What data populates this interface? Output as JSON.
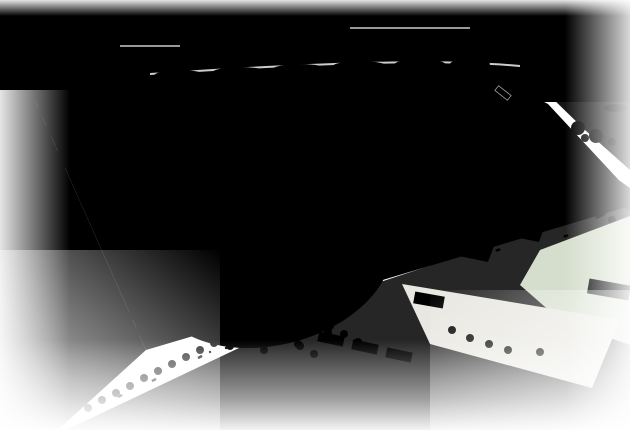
{
  "meta": {
    "kind": "watercolor aerial perspective rendering",
    "subject": "seaside sports park with ballfields, stadium, lawns, parking and coastal river",
    "canvas": {
      "width": 630,
      "height": 430
    }
  },
  "scene": {
    "features": [
      "ocean with breakwater jetty at top",
      "beach and green dune belt",
      "perimeter forest belt",
      "two sand ballfields (upper-left)",
      "central softball stadium with sand infield, blue grandstand and tall net poles",
      "large green turf field with white lines",
      "grey gravel multipurpose ground",
      "pond and circular tree plaza",
      "three car parking lots with colored cars",
      "river mouth with bridge at upper right",
      "boulevard intersection with crosswalks at lower right",
      "faded sketch of existing lots and buildings at bottom edges"
    ]
  },
  "palette": {
    "paper": "#ffffff",
    "sky_top": "#ffffff",
    "sky": "#dff0f6",
    "sea": "#a5dbea",
    "sea_deep": "#8fd2e4",
    "sea_light": "#cfeaf3",
    "sea_streak": "#76c8dc",
    "beach": "#f0e8d2",
    "beach_bright": "#f8f2e3",
    "dune": "#c0e59d",
    "dune_dark": "#8ccf68",
    "tree_dark": "#3d9c38",
    "tree_mid": "#5fb848",
    "tree_light": "#8bcf66",
    "tree_faint": "#cfe4c2",
    "lawn_pale": "#e7f3d6",
    "lawn_light": "#c8e9a4",
    "lawn_bright": "#6fd048",
    "field_green": "#b7e492",
    "sand_light": "#e4d3af",
    "sand": "#d8c29a",
    "sand_line": "#cbb68c",
    "gravel": "#e0dfd5",
    "gravel_dot": "#bdbcae",
    "road": "#9ba1a6",
    "road_light": "#c9cdcf",
    "sidewalk": "#dadcd8",
    "path": "#ecebe0",
    "median": "#56bd45",
    "pond": "#a9deed",
    "river": "#93d4e4",
    "bank_green": "#7cc95e",
    "asphalt": "#c6c9cc",
    "lot_faded": "#ebeae3",
    "speckle": "#f1f1ed",
    "speckle_dot": "#b9b9b2",
    "stand_blue": "#4f7fc4",
    "stand_dark": "#38619e",
    "bldg_white": "#f6f6f2",
    "bldg_grey": "#d9dbd7",
    "bldg_edge": "#b0b0a6",
    "roof_tan": "#e2cf96",
    "line_white": "#ffffff",
    "fence_grey": "#c6cbcd",
    "sketch": "#d6d5cd",
    "sketch_green": "#c4d9b2",
    "sketch_tan": "#dcd3ba",
    "car_red": "#cf3d3a",
    "car_blue": "#3f65c0",
    "car_white": "#fafafa",
    "car_silver": "#bfc3c7",
    "car_dark": "#4e545b",
    "dot_red": "#d04040",
    "dot_blue": "#3a62c0",
    "dot_dark": "#555b63"
  }
}
